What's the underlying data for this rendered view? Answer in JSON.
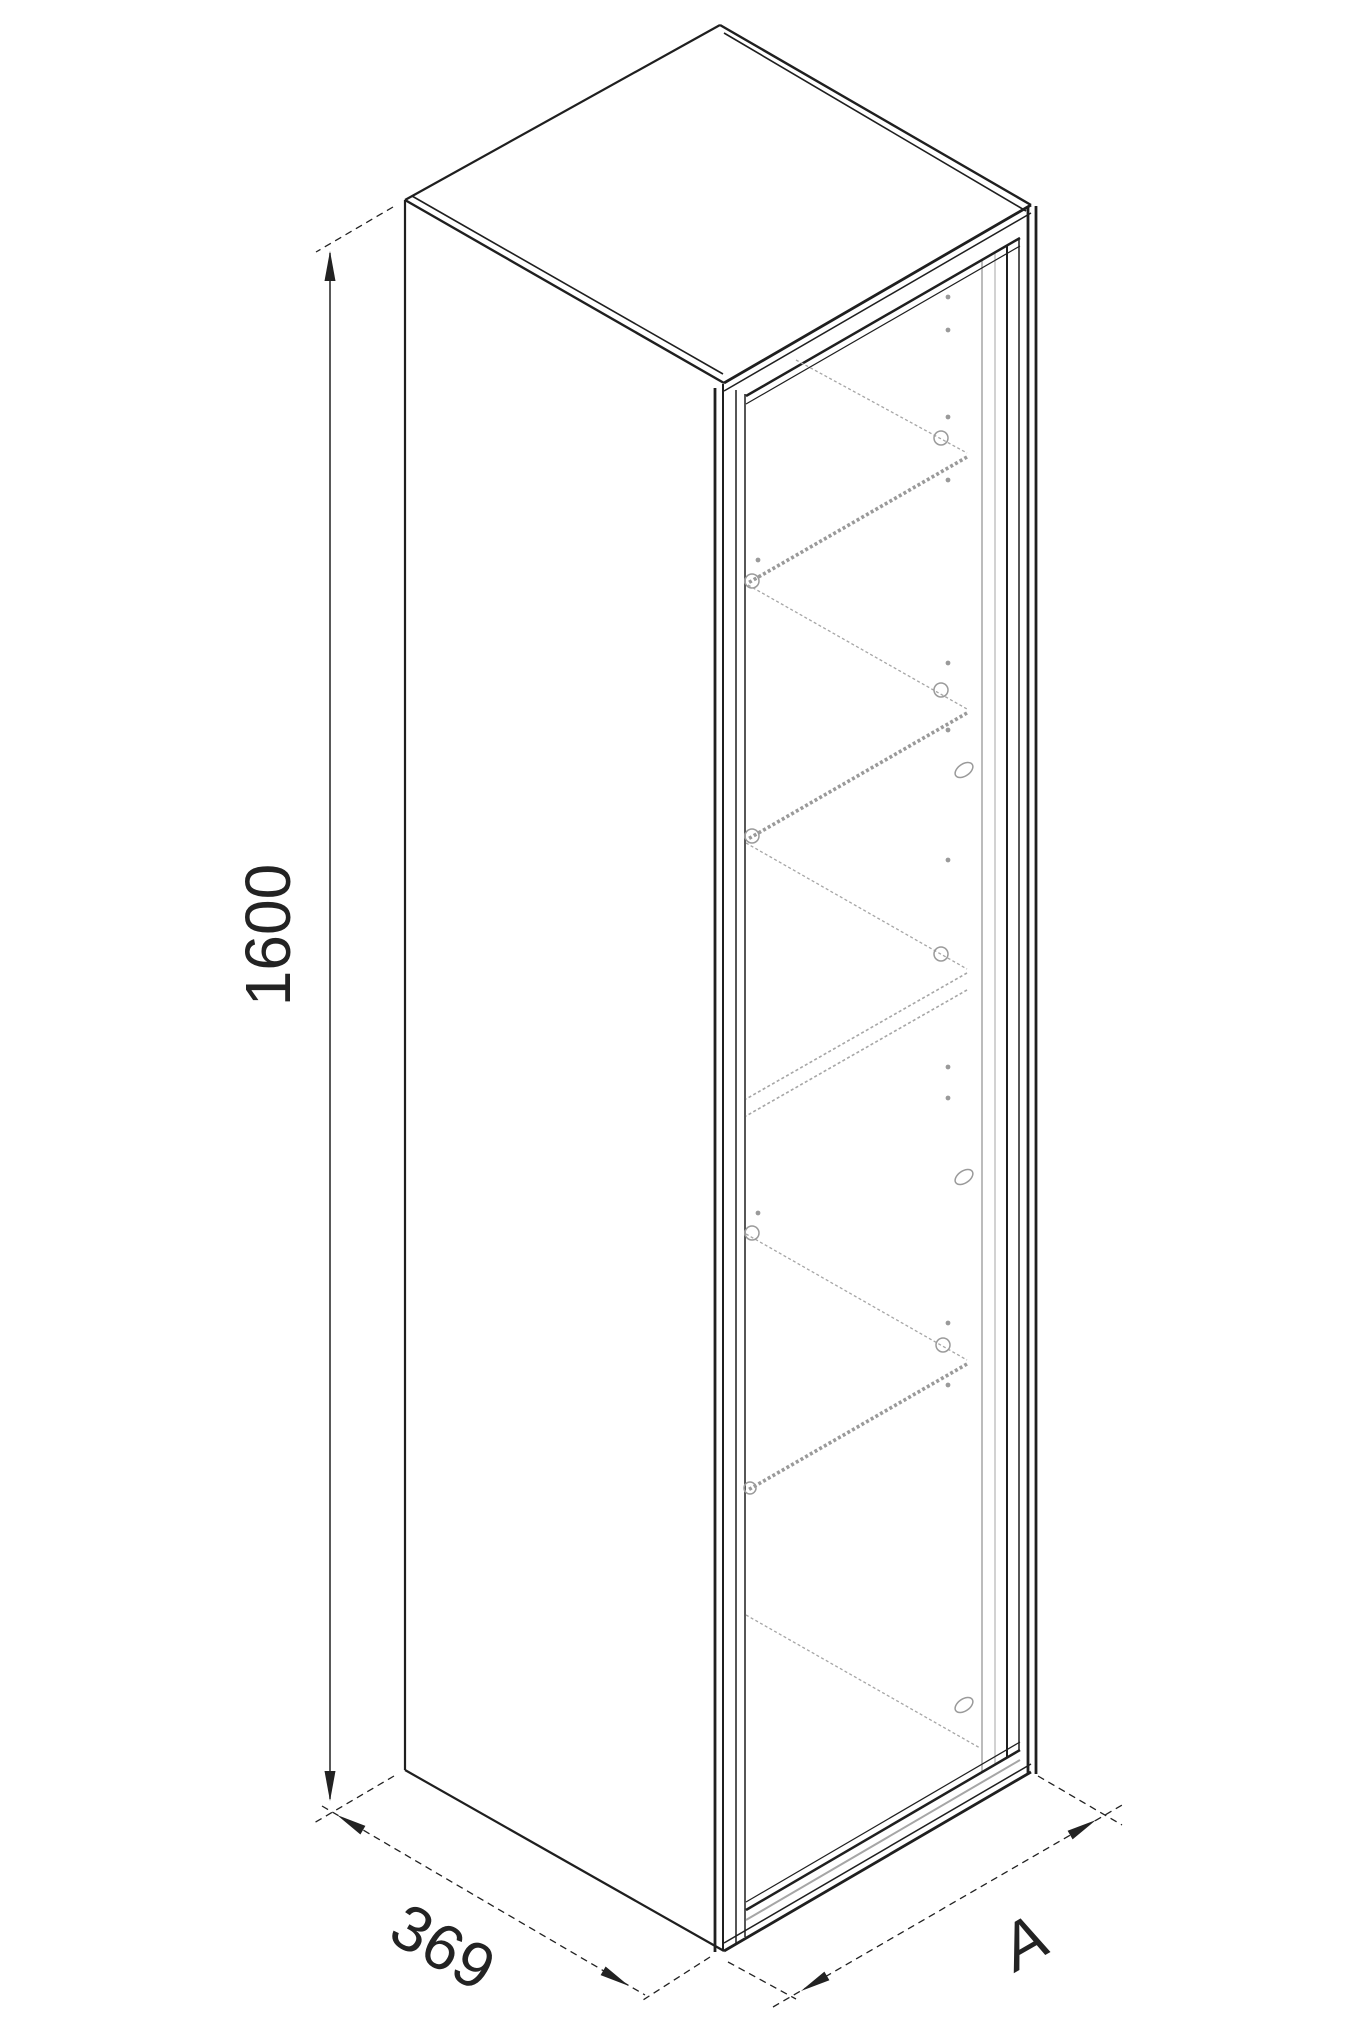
{
  "drawing": {
    "kind": "isometric-technical-drawing-of-tall-cabinet-with-glass-door-and-shelves",
    "background_color": "#ffffff",
    "ink_color": "#1f1f1f",
    "light_line_color": "#a6a6a6",
    "shelf_count": 4,
    "dimensions": {
      "height": "1600",
      "depth": "369",
      "width": "A"
    }
  }
}
